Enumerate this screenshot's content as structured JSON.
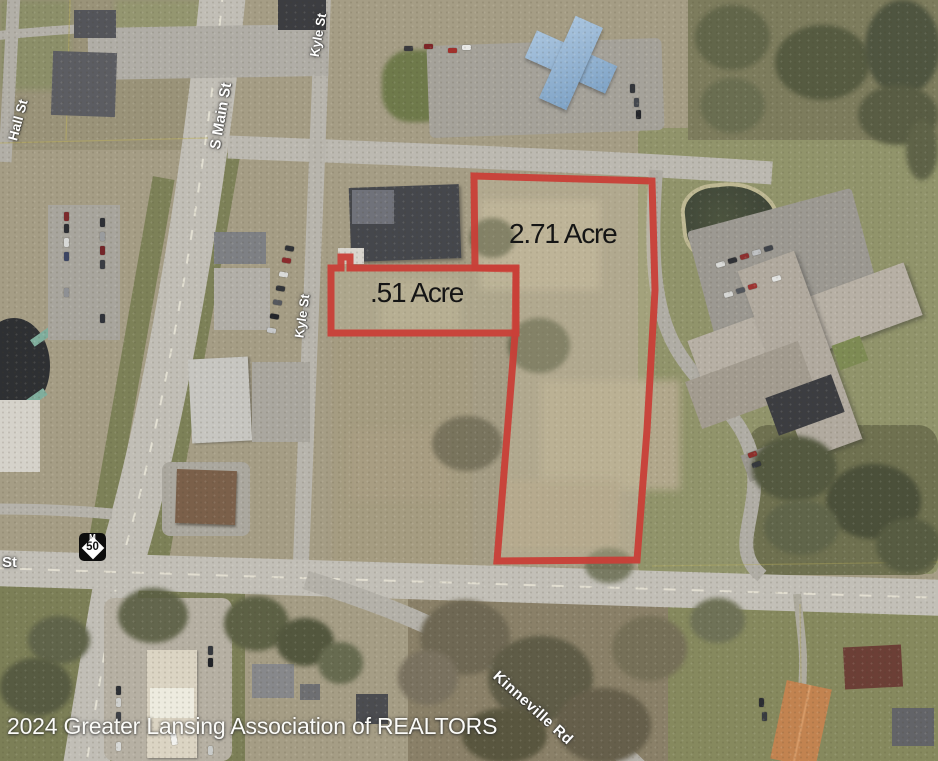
{
  "annotations": {
    "parcel_large": "2.71 Acre",
    "parcel_small": ".51 Acre"
  },
  "streets": {
    "hall": "Hall St",
    "s_main": "S Main St",
    "kyle_top": "Kyle St",
    "kyle_mid": "Kyle St",
    "st_fragment": "St",
    "kinneville": "Kinneville Rd"
  },
  "route_shield": {
    "state_letter": "M",
    "route_number": "50"
  },
  "footer": {
    "copyright": "2024 Greater Lansing Association of REALTORS"
  },
  "colors": {
    "parcel_outline": "#ca4038",
    "acre_text": "#151515",
    "street_label": "#ffffff"
  }
}
